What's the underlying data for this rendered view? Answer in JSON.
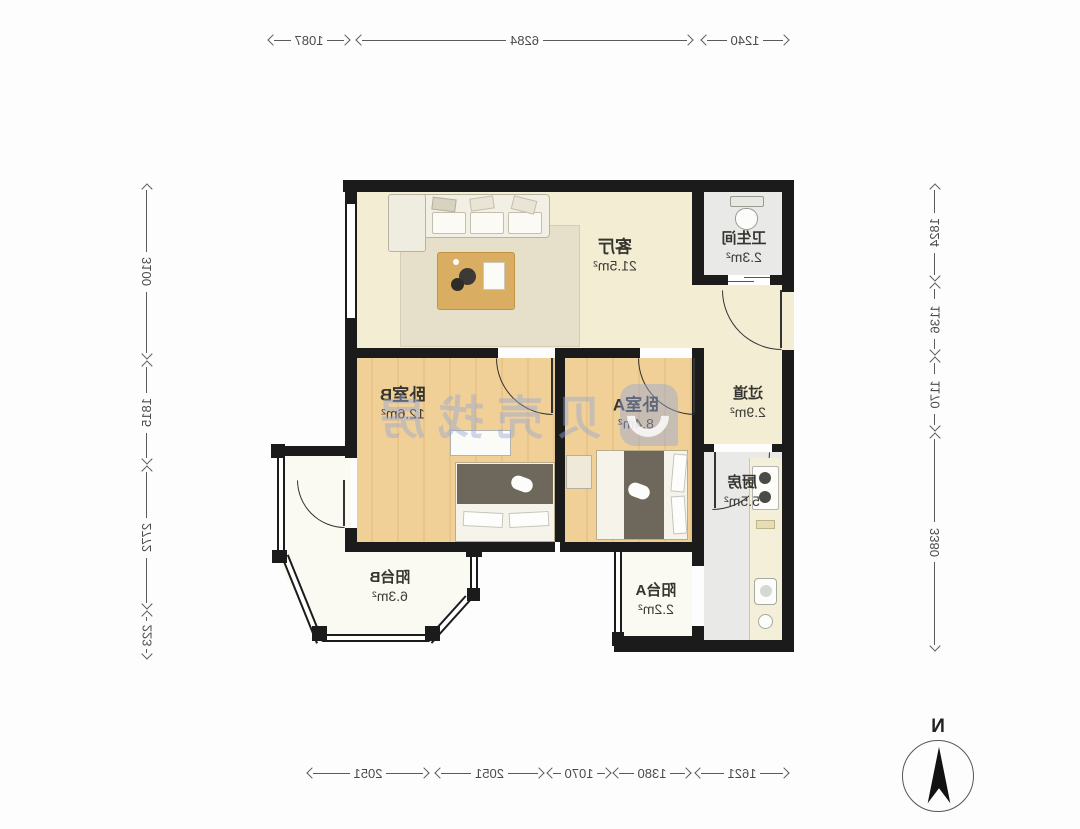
{
  "meta": {
    "type": "apartment-floor-plan",
    "mirrored": true
  },
  "rooms": {
    "living": {
      "name": "客厅",
      "area": "21.5m²"
    },
    "bathroom": {
      "name": "卫生间",
      "area": "2.3m²"
    },
    "bedroom_b": {
      "name": "卧室B",
      "area": "12.6m²"
    },
    "bedroom_a": {
      "name": "卧室A",
      "area": "8.4m²"
    },
    "hallway": {
      "name": "过道",
      "area": "2.9m²"
    },
    "kitchen": {
      "name": "厨房",
      "area": "5.5m²"
    },
    "balcony_b": {
      "name": "阳台B",
      "area": "6.3m²"
    },
    "balcony_a": {
      "name": "阳台A",
      "area": "2.2m²"
    }
  },
  "dimensions": {
    "top": [
      "1240",
      "6284",
      "1087"
    ],
    "bottom": [
      "1621",
      "1380",
      "1070",
      "2051",
      "2051"
    ],
    "left": [
      "1824",
      "1136",
      "1170",
      "3380"
    ],
    "right": [
      "3100",
      "1815",
      "2772",
      "223"
    ]
  },
  "compass": {
    "label": "N"
  },
  "watermark": {
    "text": "贝壳找房"
  },
  "colors": {
    "wall": "#1b1b1b",
    "floor_cream": "#f3edd4",
    "floor_wood": "#f0d096",
    "floor_gray": "#e9e9e7",
    "floor_balcony": "#fafaf3",
    "watermark_blue": "#94a6d8",
    "dimension_text": "#4a4a4a"
  }
}
